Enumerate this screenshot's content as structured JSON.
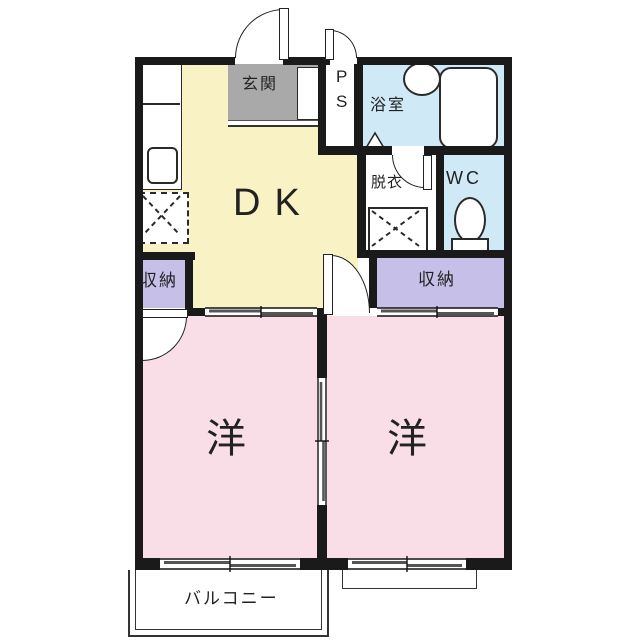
{
  "rooms": {
    "genkan": {
      "label": "玄関"
    },
    "ps": {
      "line1": "P",
      "line2": "S"
    },
    "bathroom": {
      "label": "浴室"
    },
    "dressing_room": {
      "label": "脱衣"
    },
    "toilet": {
      "label": "WC"
    },
    "dining_kitchen": {
      "label": "DK"
    },
    "closet_left": {
      "label": "収納"
    },
    "closet_right": {
      "label": "収納"
    },
    "western_room_left": {
      "label": "洋"
    },
    "western_room_right": {
      "label": "洋"
    },
    "balcony": {
      "label": "バルコニー"
    }
  },
  "fixtures": {
    "bathtub": "bathtub",
    "wash_basin": "wash-basin",
    "toilet_bowl": "toilet-bowl",
    "washing_machine_space": "washing-machine-space",
    "refrigerator_space": "refrigerator-space",
    "kitchen_counter": "kitchen-counter",
    "kitchen_sink": "kitchen-sink",
    "shoe_cabinet": "shoe-cabinet"
  },
  "colors": {
    "wall": "#1a1a1a",
    "dining_kitchen": "#f8f2c5",
    "western_room": "#f9dde7",
    "closet": "#c6bfe7",
    "wet_area": "#cfe9f6",
    "genkan_floor": "#a9a9a9",
    "text": "#222222",
    "background": "#ffffff"
  }
}
